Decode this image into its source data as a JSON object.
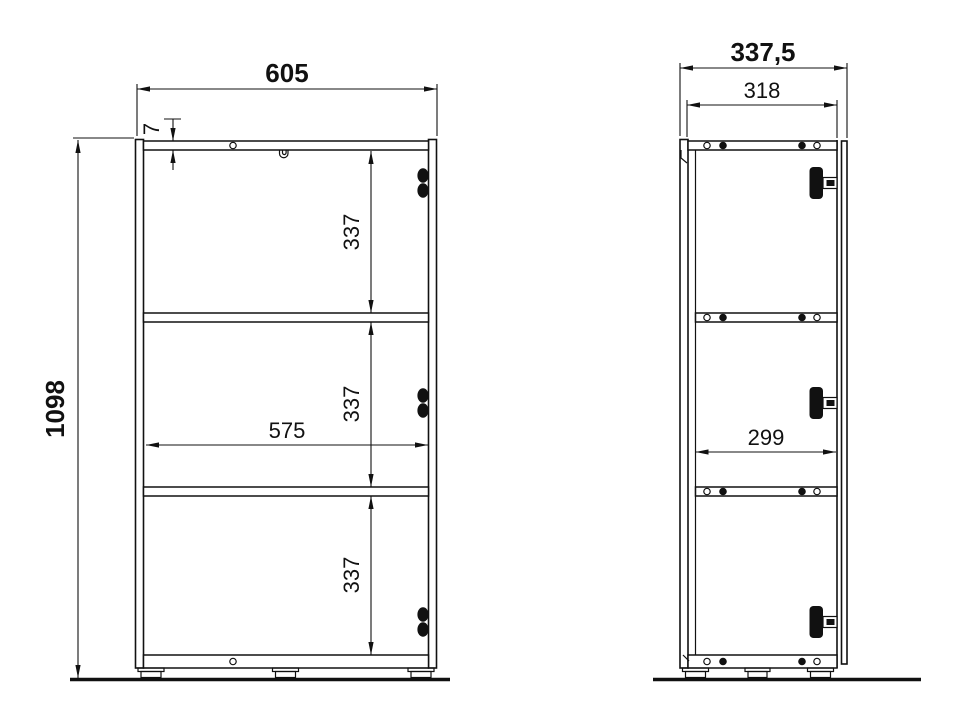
{
  "drawing": {
    "front": {
      "width": "605",
      "height": "1098",
      "top_thickness": "7",
      "interior_width": "575",
      "shelf_spacing": [
        "337",
        "337",
        "337"
      ]
    },
    "side": {
      "depth_total": "337,5",
      "depth_body": "318",
      "depth_interior": "299"
    },
    "colors": {
      "line": "#111111",
      "background": "#ffffff"
    }
  }
}
